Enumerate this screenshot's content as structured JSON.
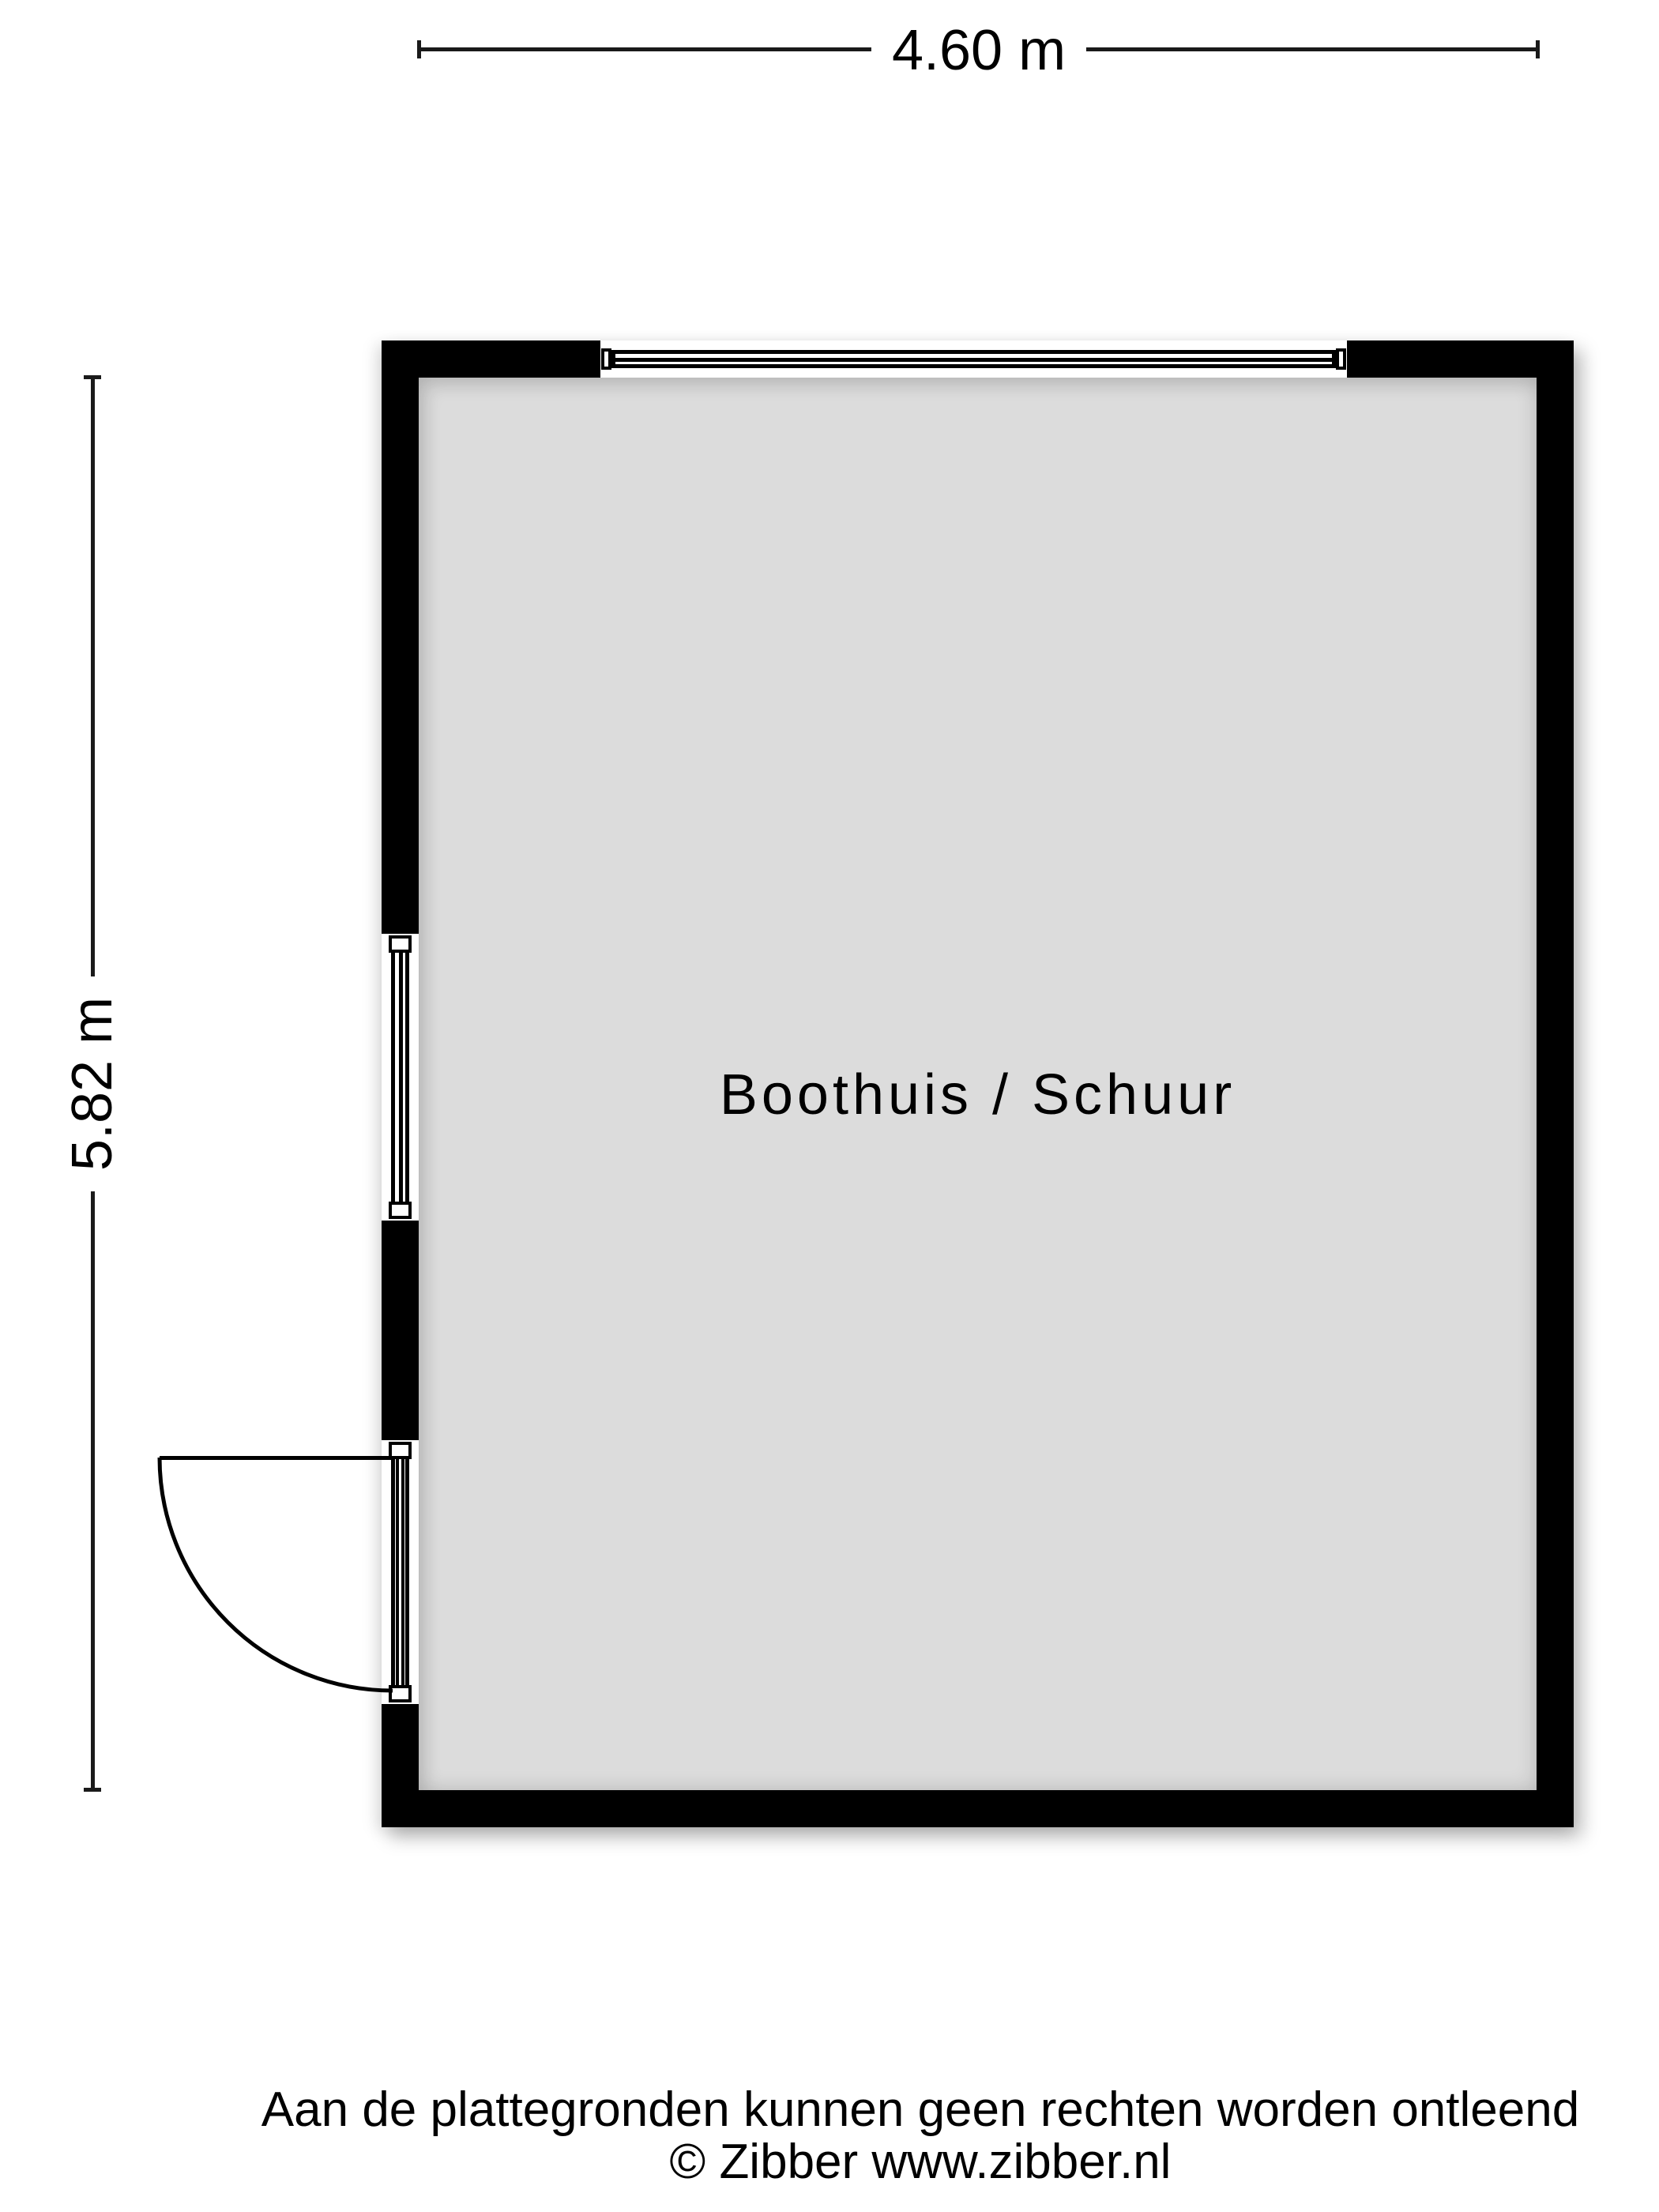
{
  "floorplan": {
    "room_label": "Boothuis / Schuur",
    "dimensions": {
      "width_label": "4.60 m",
      "height_label": "5.82 m",
      "width_m": 4.6,
      "height_m": 5.82
    },
    "colors": {
      "wall": "#000000",
      "floor": "#DCDCDC",
      "background": "#FFFFFF"
    }
  },
  "footer": {
    "disclaimer": "Aan de plattegronden kunnen geen rechten worden ontleend",
    "copyright": "© Zibber www.zibber.nl"
  }
}
